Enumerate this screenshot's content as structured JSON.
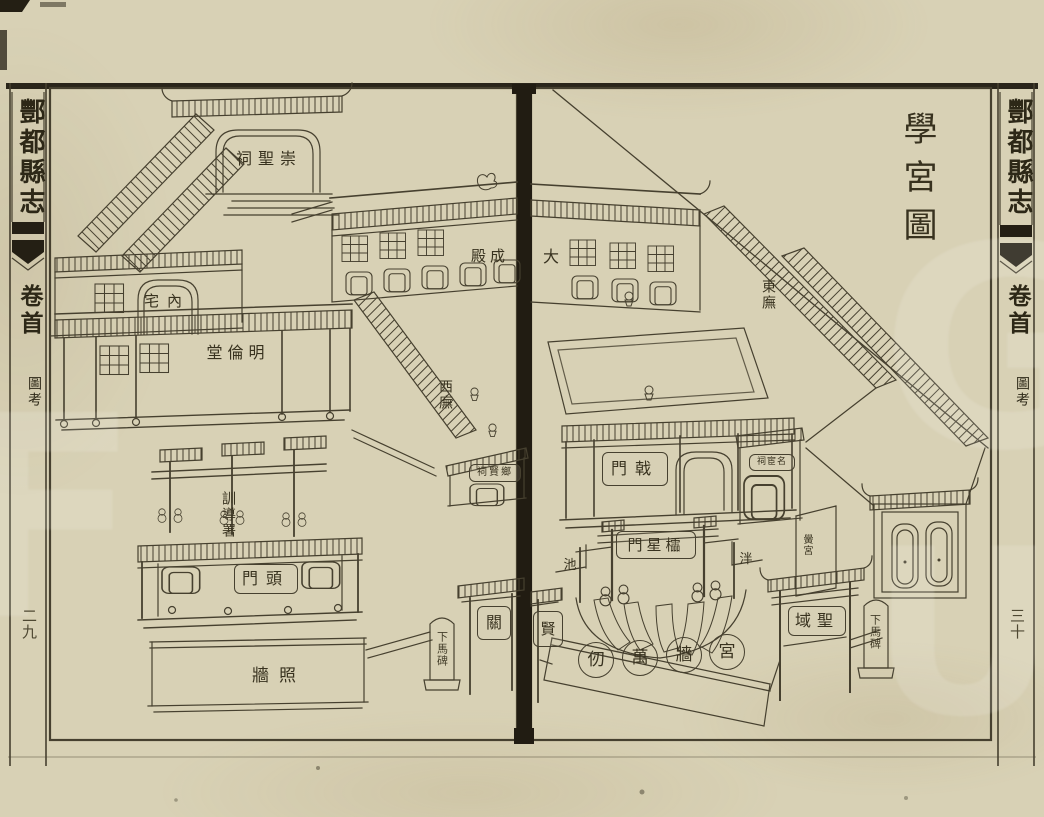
{
  "colors": {
    "paper": "#d8d1b5",
    "ink": "#46402f",
    "gutter": "#211c12"
  },
  "left_margin": {
    "book_title": "酆都縣志",
    "volume": "卷首",
    "section": "圖考",
    "page_number": "二九"
  },
  "right_margin": {
    "book_title": "酆都縣志",
    "volume": "卷首",
    "section": "圖考",
    "page_number": "三十"
  },
  "left_page": {
    "labels": [
      {
        "name": "chongsheng-shrine",
        "text": "崇聖祠",
        "display": "祠聖崇",
        "style": "plain",
        "x": 230,
        "y": 146,
        "w": 78,
        "h": 26,
        "fs": 16,
        "ls": 6
      },
      {
        "name": "inner-residence",
        "text": "內宅",
        "display": "宅內",
        "style": "plain",
        "x": 142,
        "y": 290,
        "w": 50,
        "h": 22,
        "fs": 15,
        "ls": 8
      },
      {
        "name": "minglun-hall",
        "text": "明倫堂",
        "display": "堂倫明",
        "style": "plain",
        "x": 200,
        "y": 342,
        "w": 76,
        "h": 22,
        "fs": 16,
        "ls": 5
      },
      {
        "name": "xundao-office",
        "text": "訓導署",
        "display": "訓導署",
        "style": "vertical",
        "x": 219,
        "y": 486,
        "w": 18,
        "h": 58,
        "fs": 14,
        "ls": 2
      },
      {
        "name": "front-gate",
        "text": "頭門",
        "display": "門頭",
        "style": "plaque",
        "x": 234,
        "y": 564,
        "w": 62,
        "h": 28,
        "fs": 16,
        "ls": 8
      },
      {
        "name": "screen-wall",
        "text": "照牆",
        "display": "牆照",
        "style": "plain",
        "x": 246,
        "y": 664,
        "w": 66,
        "h": 24,
        "fs": 17,
        "ls": 10
      },
      {
        "name": "west-wing",
        "text": "西廡",
        "display": "西廡",
        "style": "vertical",
        "x": 436,
        "y": 372,
        "w": 18,
        "h": 46,
        "fs": 14,
        "ls": 2
      },
      {
        "name": "dacheng-hall-left-half",
        "text": "成殿",
        "display": "殿成",
        "style": "plain",
        "x": 466,
        "y": 246,
        "w": 48,
        "h": 20,
        "fs": 15,
        "ls": 4
      },
      {
        "name": "xiangxian-shrine",
        "text": "鄉賢祠",
        "display": "祠賢鄉",
        "style": "plaque",
        "x": 469,
        "y": 464,
        "w": 50,
        "h": 16,
        "fs": 10,
        "ls": 2
      },
      {
        "name": "xianguan-gate-left-half",
        "text": "關",
        "display": "關",
        "style": "plaque",
        "x": 477,
        "y": 606,
        "w": 32,
        "h": 32,
        "fs": 16,
        "ls": 0
      },
      {
        "name": "dismount-stele-left",
        "text": "下馬碑",
        "display": "下馬碑",
        "style": "stele",
        "x": 433,
        "y": 622,
        "w": 18,
        "h": 54,
        "fs": 11,
        "ls": 1
      }
    ]
  },
  "right_page": {
    "labels": [
      {
        "name": "diagram-title",
        "text": "學宮圖",
        "display": "學宮圖",
        "style": "title",
        "x": 898,
        "y": 110,
        "w": 38,
        "h": 146,
        "fs": 34,
        "ls": 14
      },
      {
        "name": "dacheng-hall-right-half",
        "text": "大",
        "display": "大",
        "style": "plain",
        "x": 539,
        "y": 246,
        "w": 24,
        "h": 22,
        "fs": 16,
        "ls": 0
      },
      {
        "name": "east-wing",
        "text": "東廡",
        "display": "東廡",
        "style": "vertical",
        "x": 759,
        "y": 270,
        "w": 18,
        "h": 50,
        "fs": 14,
        "ls": 2
      },
      {
        "name": "ji-gate",
        "text": "戟門",
        "display": "門戟",
        "style": "plaque",
        "x": 602,
        "y": 452,
        "w": 64,
        "h": 32,
        "fs": 16,
        "ls": 8
      },
      {
        "name": "minghuan-shrine",
        "text": "名宦祠",
        "display": "祠宦名",
        "style": "plaque",
        "x": 749,
        "y": 454,
        "w": 44,
        "h": 15,
        "fs": 9,
        "ls": 1
      },
      {
        "name": "lingxing-gate",
        "text": "櫺星門",
        "display": "門星櫺",
        "style": "plaque",
        "x": 616,
        "y": 531,
        "w": 78,
        "h": 26,
        "fs": 15,
        "ls": 4
      },
      {
        "name": "pan-pond-chi",
        "text": "池",
        "display": "池",
        "style": "plain",
        "x": 561,
        "y": 556,
        "w": 18,
        "h": 18,
        "fs": 13,
        "ls": 0
      },
      {
        "name": "pan-pond-pan",
        "text": "泮",
        "display": "泮",
        "style": "plain",
        "x": 737,
        "y": 550,
        "w": 18,
        "h": 18,
        "fs": 13,
        "ls": 0
      },
      {
        "name": "shengyu-gate",
        "text": "聖域",
        "display": "域聖",
        "style": "plaque",
        "x": 788,
        "y": 606,
        "w": 56,
        "h": 28,
        "fs": 16,
        "ls": 6
      },
      {
        "name": "xianguan-gate-right-half",
        "text": "賢",
        "display": "賢",
        "style": "plaque",
        "x": 533,
        "y": 611,
        "w": 28,
        "h": 34,
        "fs": 15,
        "ls": 0
      },
      {
        "name": "dismount-stele-right",
        "text": "下馬碑",
        "display": "下馬碑",
        "style": "stele",
        "x": 866,
        "y": 604,
        "w": 18,
        "h": 56,
        "fs": 11,
        "ls": 1
      },
      {
        "name": "honggong-wall",
        "text": "黌宮",
        "display": "黌宮",
        "style": "vertical",
        "x": 799,
        "y": 526,
        "w": 14,
        "h": 38,
        "fs": 10,
        "ls": 1
      }
    ],
    "wall_motto": {
      "name": "palace-wall-motto",
      "text": "宮牆萬仞",
      "chars_display": [
        "仞",
        "萬",
        "牆",
        "宮"
      ],
      "centers": [
        [
          595,
          659
        ],
        [
          639,
          657
        ],
        [
          683,
          654
        ],
        [
          726,
          651
        ]
      ],
      "r": 17,
      "fs": 17
    }
  }
}
